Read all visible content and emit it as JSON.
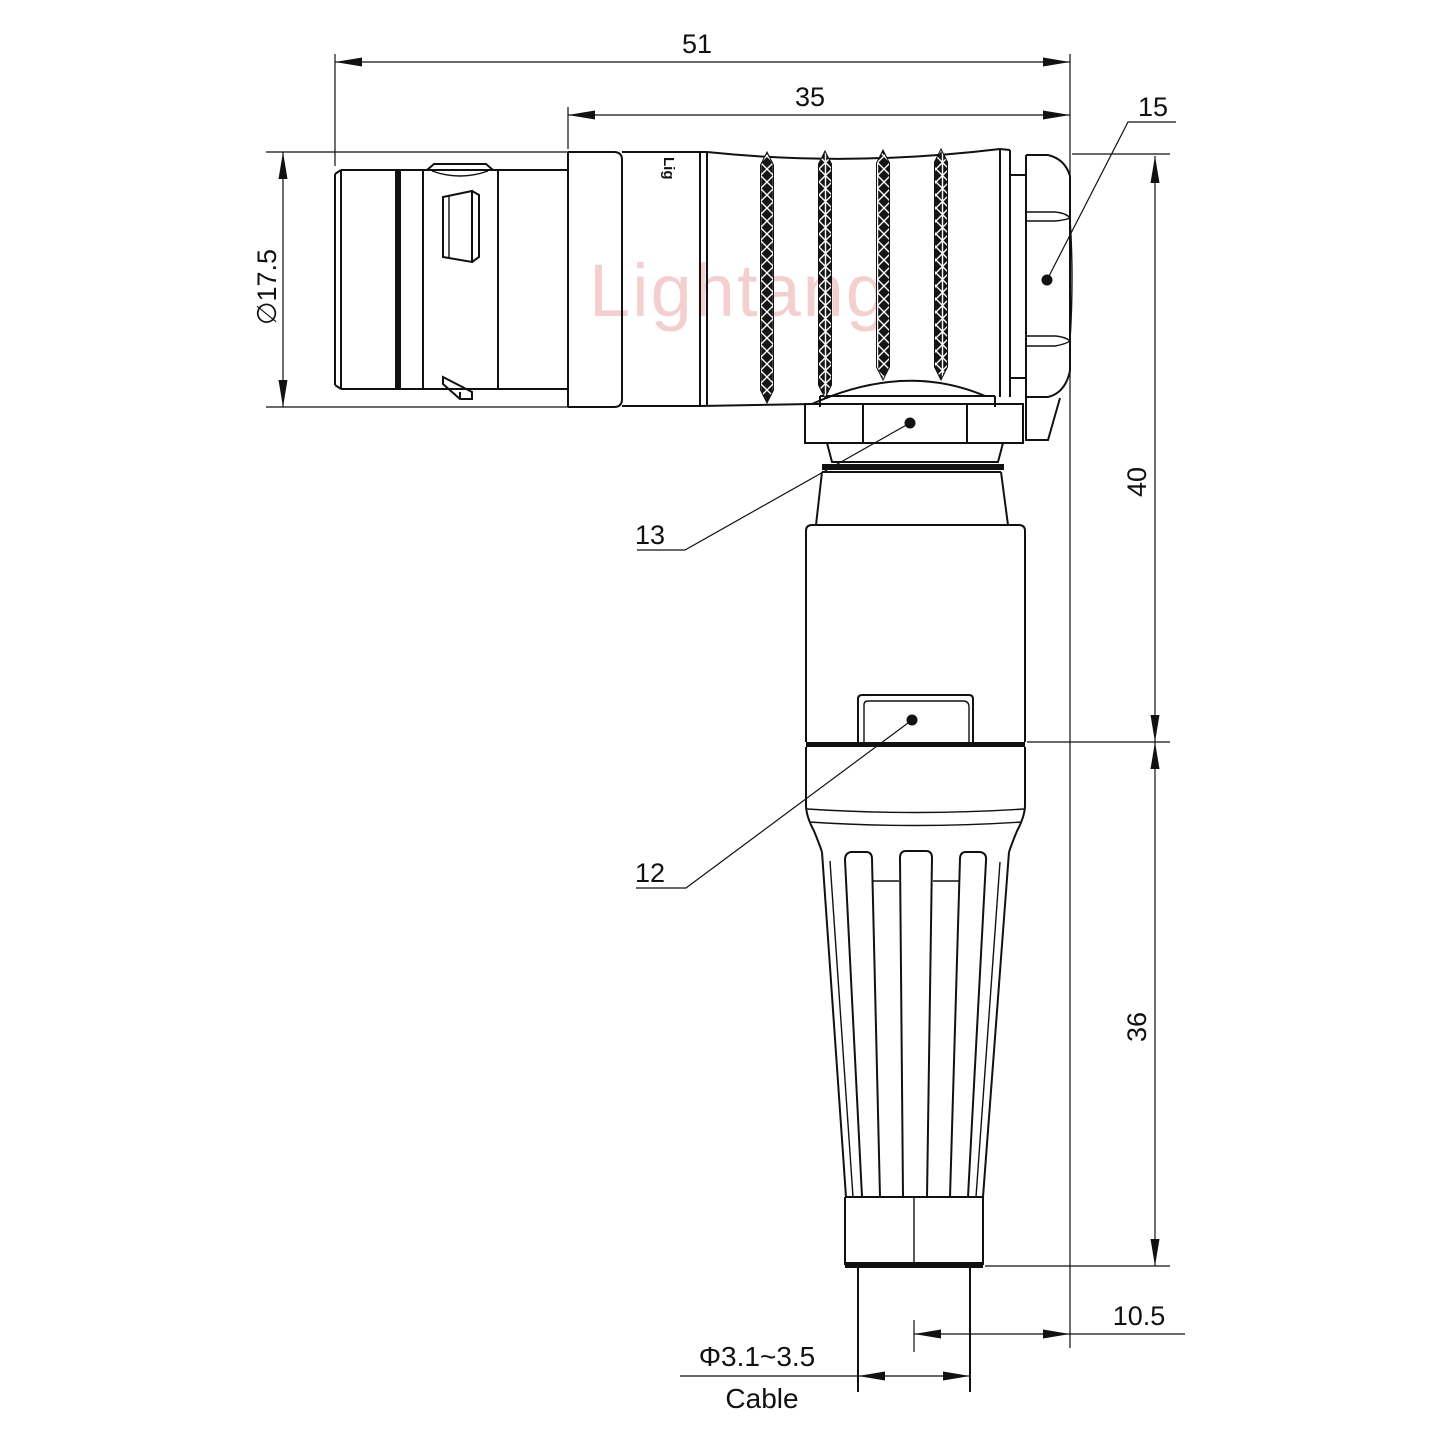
{
  "drawing": {
    "watermark": "Lightang",
    "brand_mark": "Lig",
    "dimensions": {
      "overall_length": "51",
      "front_length": "35",
      "hex_size_callout": "15",
      "plug_diameter": "∅17.5",
      "height_upper": "40",
      "height_lower": "36",
      "cable_offset": "10.5",
      "cable_diameter": "Φ3.1~3.5",
      "cable_label": "Cable",
      "callout_coupling_nut": "13",
      "callout_housing": "12"
    },
    "colors": {
      "line": "#111111",
      "watermark": "#e9a7a7",
      "background": "#ffffff"
    }
  }
}
